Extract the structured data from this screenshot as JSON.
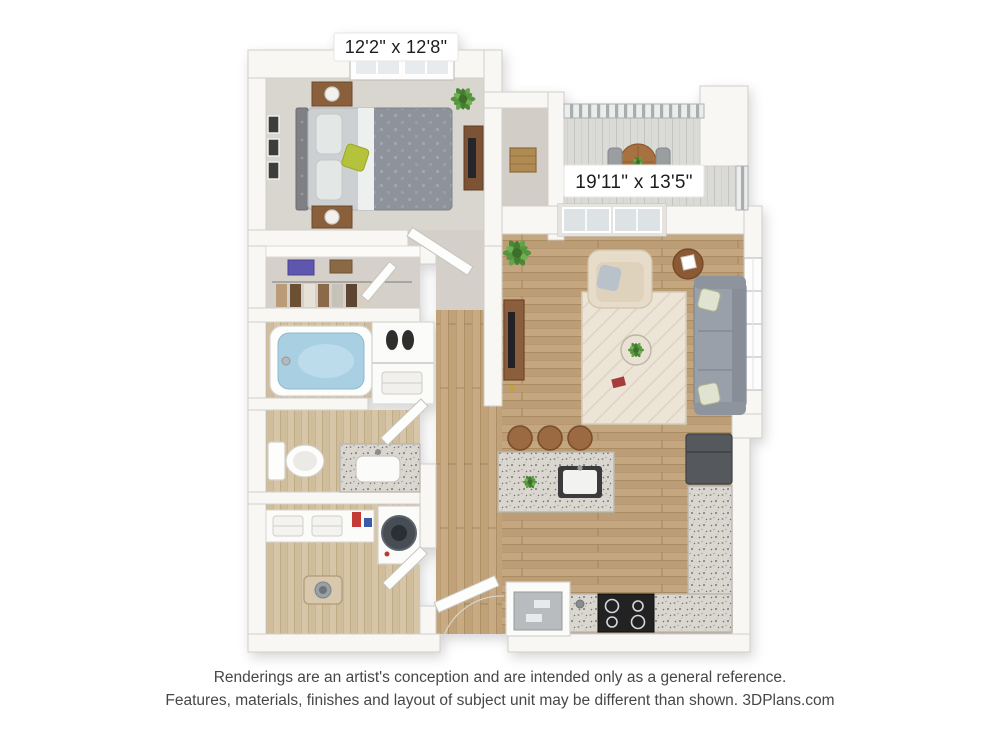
{
  "plan": {
    "dimension_labels": [
      {
        "room": "bedroom",
        "text": "12'2\" x 12'8\""
      },
      {
        "room": "living-area",
        "text": "19'11\" x 13'5\""
      }
    ],
    "furniture_icons": [
      "bed-icon",
      "nightstand-icon",
      "lamp-icon",
      "dresser-icon",
      "picture-frames-icon",
      "plant-icon",
      "wardrobe-rod-icon",
      "bathtub-icon",
      "toilet-icon",
      "vanity-sink-icon",
      "washer-icon",
      "towel-shelf-icon",
      "pet-bowl-icon",
      "sofa-icon",
      "armchair-icon",
      "area-rug-icon",
      "tv-console-icon",
      "side-table-icon",
      "kitchen-island-icon",
      "bar-stool-icon",
      "sink-icon",
      "stove-icon",
      "fridge-icon",
      "oven-cabinet-icon",
      "balcony-table-icon",
      "balcony-chair-icon",
      "railing-icon",
      "window-icon",
      "sliding-door-icon",
      "door-icon",
      "basket-icon"
    ]
  },
  "footer": {
    "line1": "Renderings are an artist's conception and are intended only as a general reference.",
    "line2": "Features, materials, finishes and layout of subject unit may be different than shown. 3DPlans.com",
    "brand": "3DPlans.com"
  },
  "colors": {
    "background": "#ffffff",
    "wall": "#f8f7f4",
    "wall_edge": "#d1cfca",
    "bedroom_carpet": "#d9d5cf",
    "closet_carpet": "#d4d0c9",
    "wood_floor": "#c4a77e",
    "bath_floor": "#d3c2a3",
    "balcony_floor": "#d9d8d5",
    "granite_counter": "#d9d6cf",
    "sofa_gray": "#99a0a9",
    "armchair_beige": "#e7dcc9",
    "rug_cream": "#ece4d6",
    "bed_duvet": "#8e939b",
    "accent_pillow_green": "#b5c23a",
    "wood_furniture": "#8a5f3b",
    "tub_water": "#a9cfe2",
    "plant_green": "#57953e",
    "stove_black": "#202023",
    "label_text": "#1e1e1e",
    "footer_text": "#474747"
  }
}
